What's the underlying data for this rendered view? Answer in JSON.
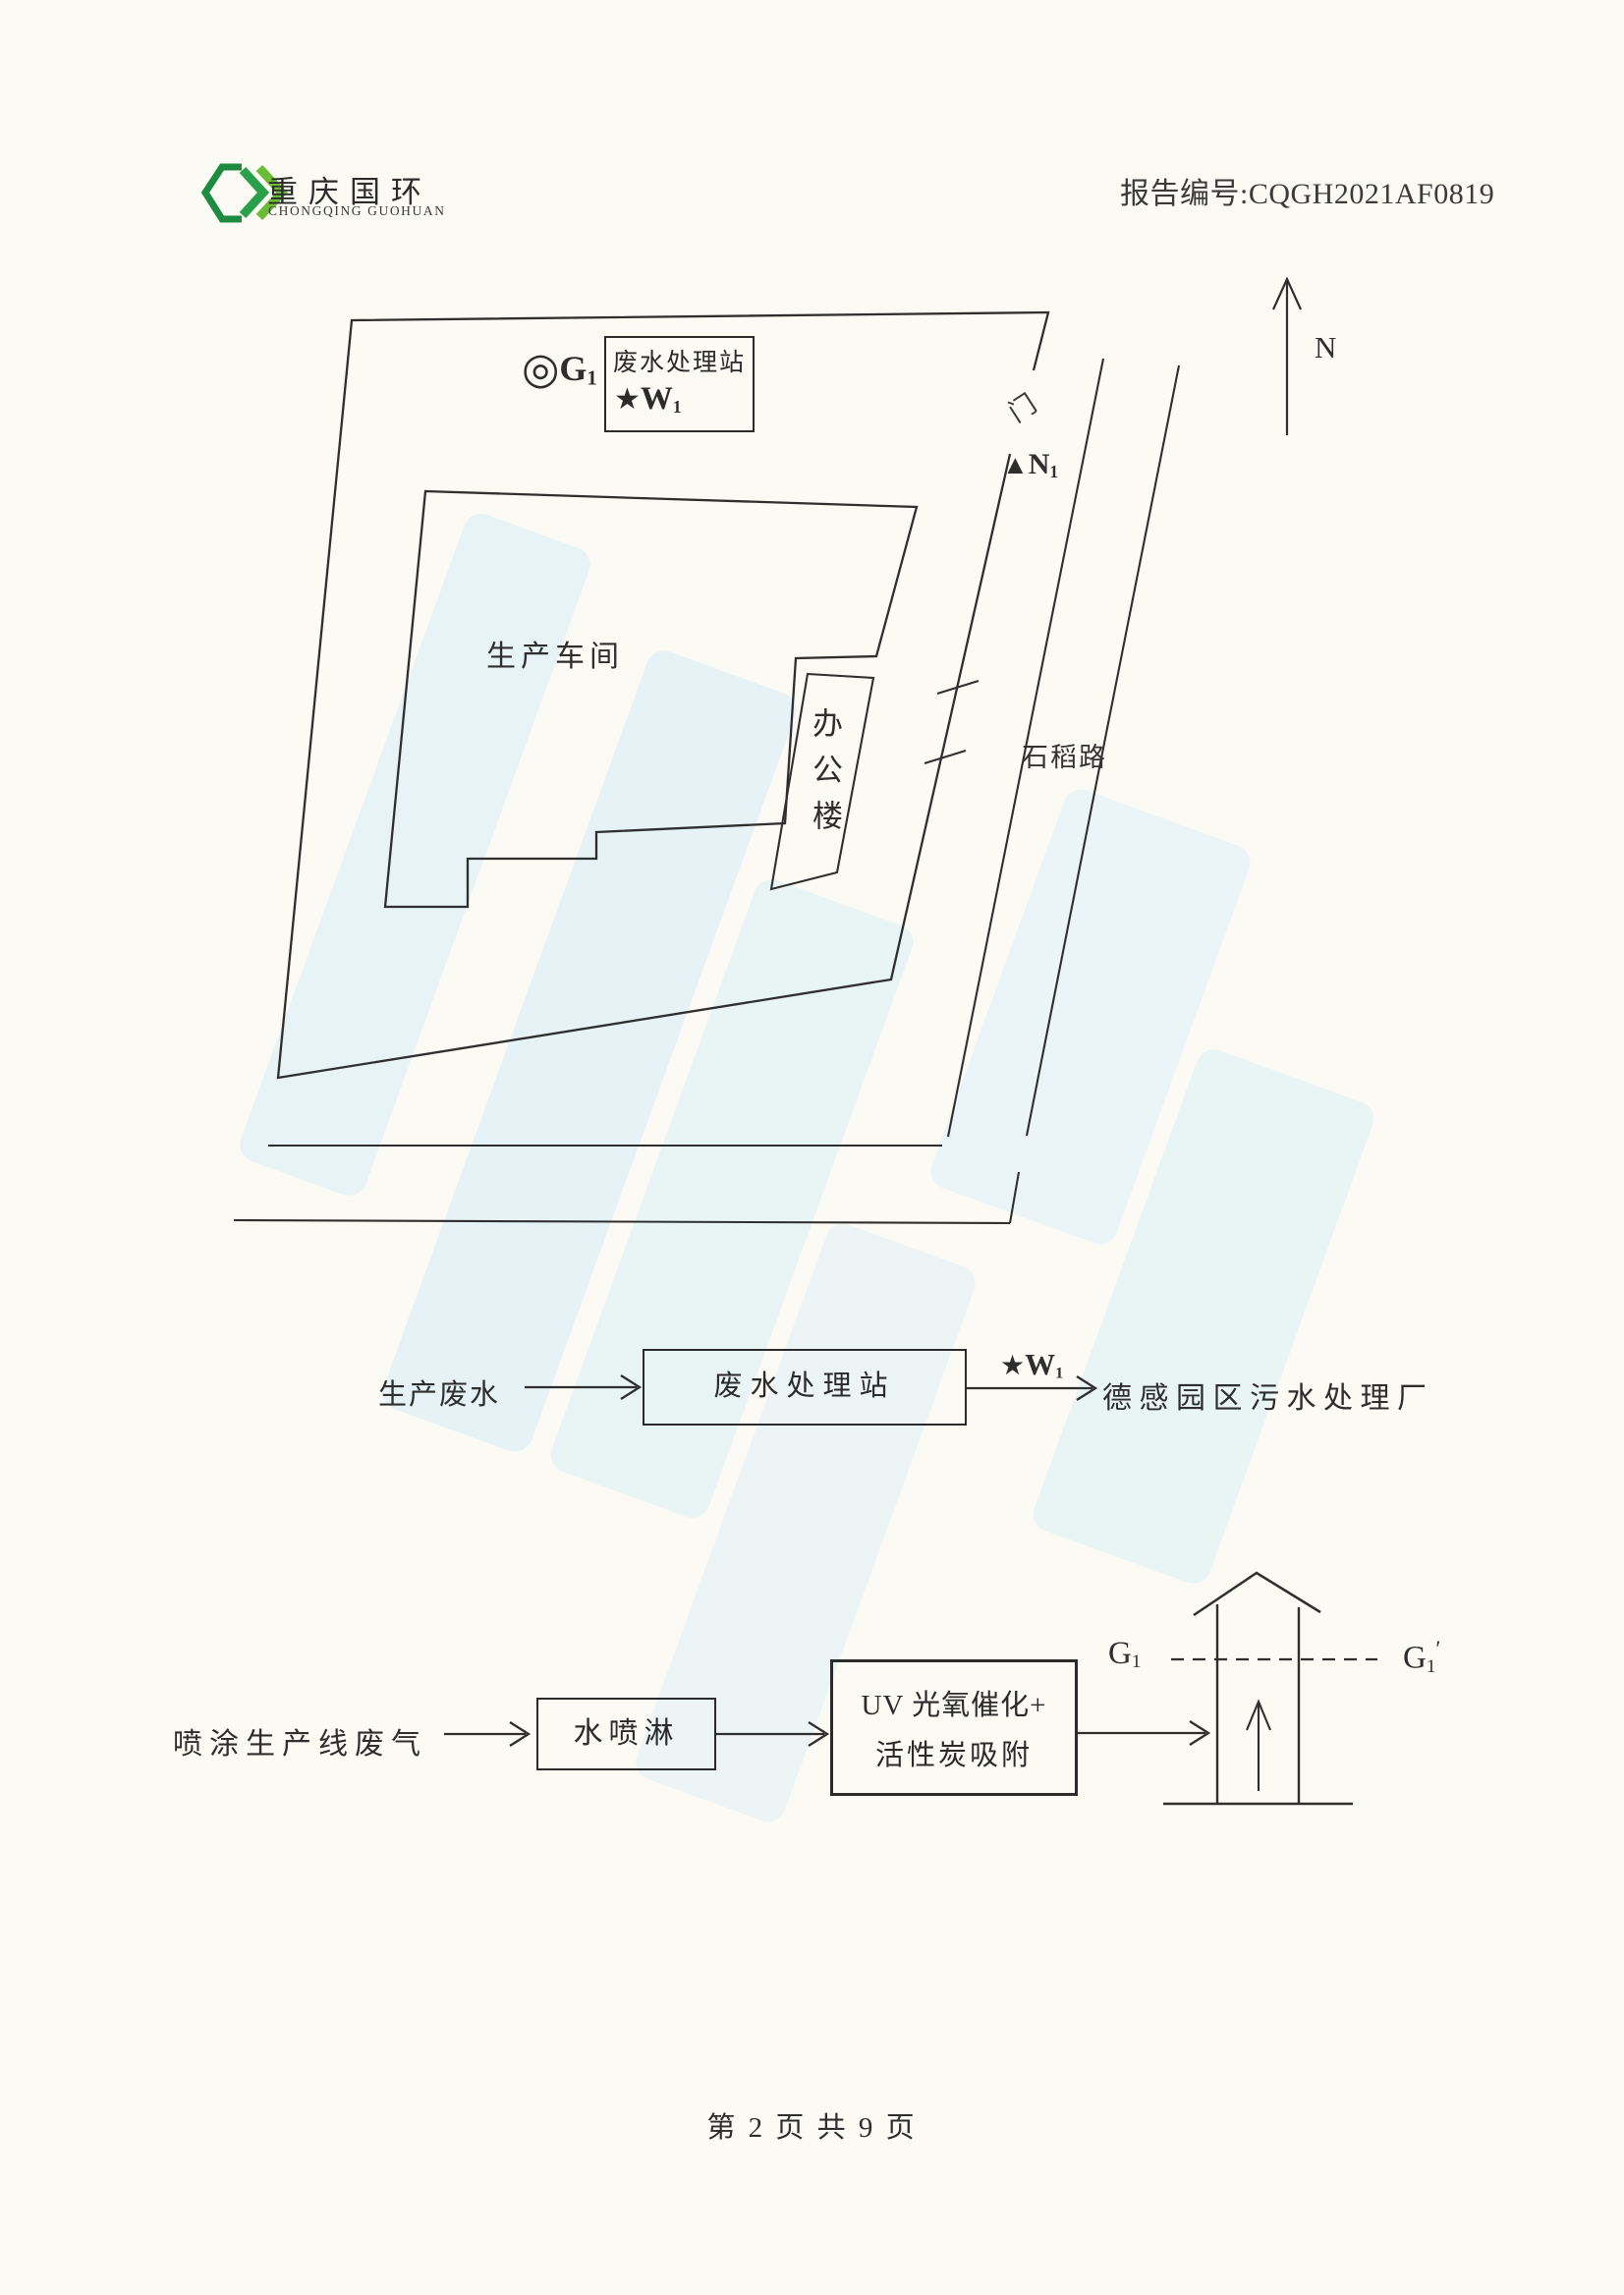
{
  "colors": {
    "paper": "#fbfaf4",
    "ink": "#2b2b2b",
    "watermark_blue": "#d9ecf8",
    "logo_green_dark": "#1d8c40",
    "logo_green_light": "#6abc34"
  },
  "header": {
    "logo_cn": "重庆国环",
    "logo_en": "CHONGQING GUOHUAN",
    "report_no": "报告编号:CQGH2021AF0819"
  },
  "site_plan": {
    "north_label": "N",
    "station_box_title": "废水处理站",
    "g1": {
      "symbol": "◎",
      "base": "G",
      "sub": "1"
    },
    "w1": {
      "symbol": "★",
      "base": "W",
      "sub": "1"
    },
    "n1": {
      "symbol": "▲",
      "base": "N",
      "sub": "1"
    },
    "workshop_label": "生产车间",
    "office_label": "办公楼",
    "gate_label": "门",
    "road_label": "石稻路"
  },
  "flow_wastewater": {
    "source": "生产废水",
    "station": "废水处理站",
    "w1": {
      "symbol": "★",
      "base": "W",
      "sub": "1"
    },
    "destination": "德感园区污水处理厂"
  },
  "flow_gas": {
    "source": "喷涂生产线废气",
    "spray_box": "水喷淋",
    "uv_line1": "UV 光氧催化+",
    "uv_line2": "活性炭吸附",
    "g1": {
      "base": "G",
      "sub": "1"
    },
    "g1_prime": {
      "base": "G",
      "sub": "1",
      "prime": "′"
    }
  },
  "footer": {
    "page_info": "第 2 页 共 9 页"
  }
}
